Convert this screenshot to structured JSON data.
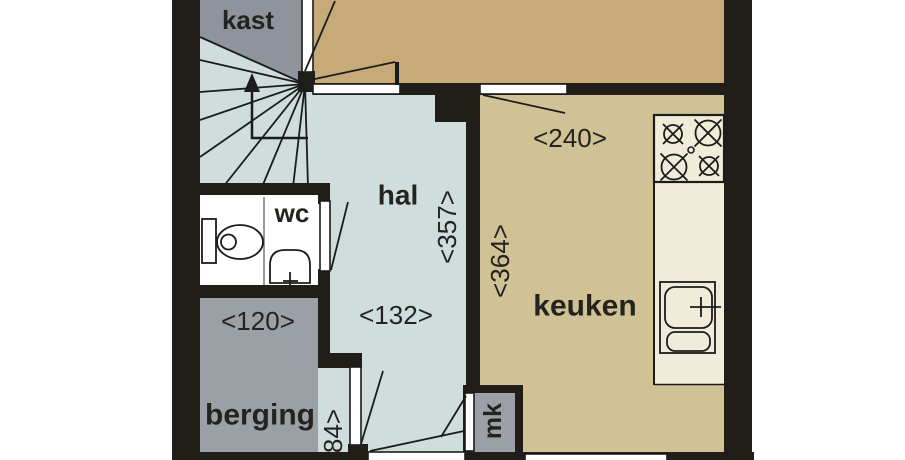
{
  "floorplan": {
    "rooms": {
      "kast": "kast",
      "hal": "hal",
      "wc": "wc",
      "keuken": "keuken",
      "berging": "berging",
      "mk": "mk"
    },
    "dimensions": {
      "room_top_width": "<240>",
      "hal_depth": "<357>",
      "hal_width": "<132>",
      "keuken_depth": "<364>",
      "berging_width": "<120>",
      "entry_width": "84>"
    },
    "colors": {
      "wall": "#211d18",
      "hal_floor": "#cfdddd",
      "keuken_floor": "#d1c296",
      "top_room_floor": "#c6ab79",
      "kast_gray": "#8f939b",
      "berging_gray": "#9aa0a6",
      "counter_cream": "#f1ecd9",
      "wc_floor": "#ffffff",
      "outside": "#ffffff"
    }
  }
}
